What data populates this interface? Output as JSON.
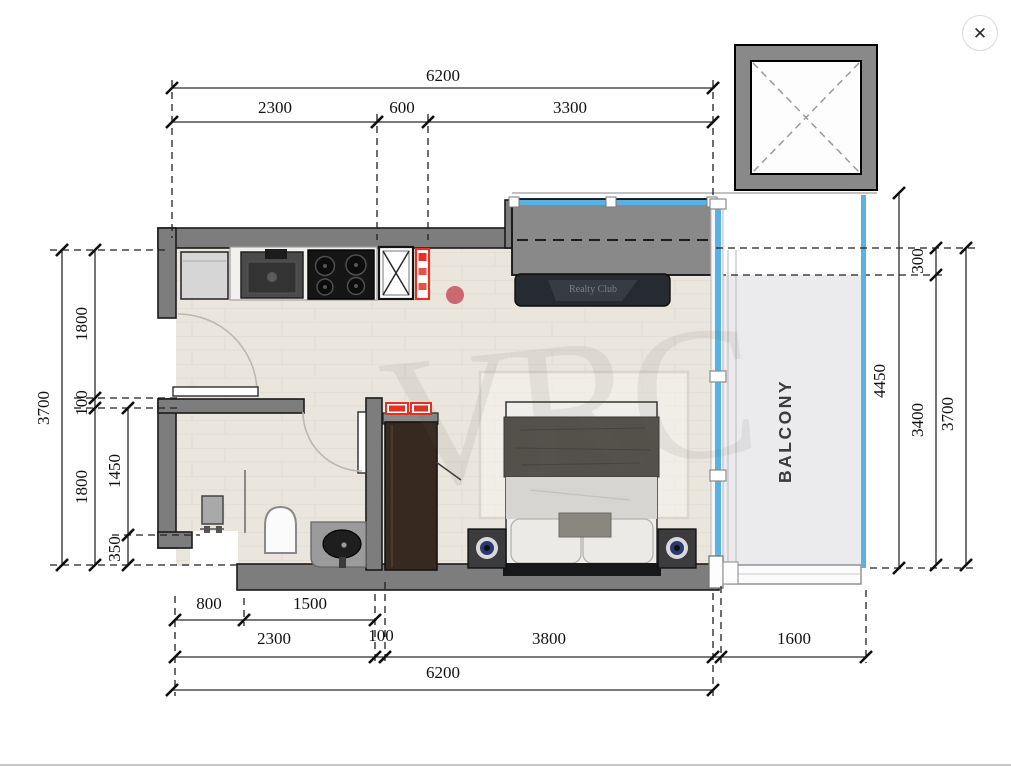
{
  "window": {
    "close_icon": "✕"
  },
  "watermark": {
    "brand": "VRC",
    "console": "Realty Club"
  },
  "rooms": {
    "balcony_label": "BALCONY"
  },
  "dimensions": {
    "top_total": "6200",
    "top_segments": [
      "2300",
      "600",
      "3300"
    ],
    "left_total": "3700",
    "left_mid": [
      "1800",
      "100",
      "1800"
    ],
    "left_inner": [
      "1450",
      "350"
    ],
    "right_overall": "4450",
    "right_top_offset": "300",
    "right_inner": "3400",
    "right_outer": "3700",
    "bottom_row1": [
      "800",
      "1500"
    ],
    "bottom_row2": [
      "2300",
      "100",
      "3800"
    ],
    "bottom_balcony": "1600",
    "bottom_total": "6200"
  },
  "colors": {
    "wall_gray": "#7d7d7d",
    "glass_blue": "#58b2e3",
    "riser_red": "#e33224",
    "wood_floor": "#eae6de",
    "balcony_floor": "#ebebee",
    "dim_text": "#111111"
  }
}
